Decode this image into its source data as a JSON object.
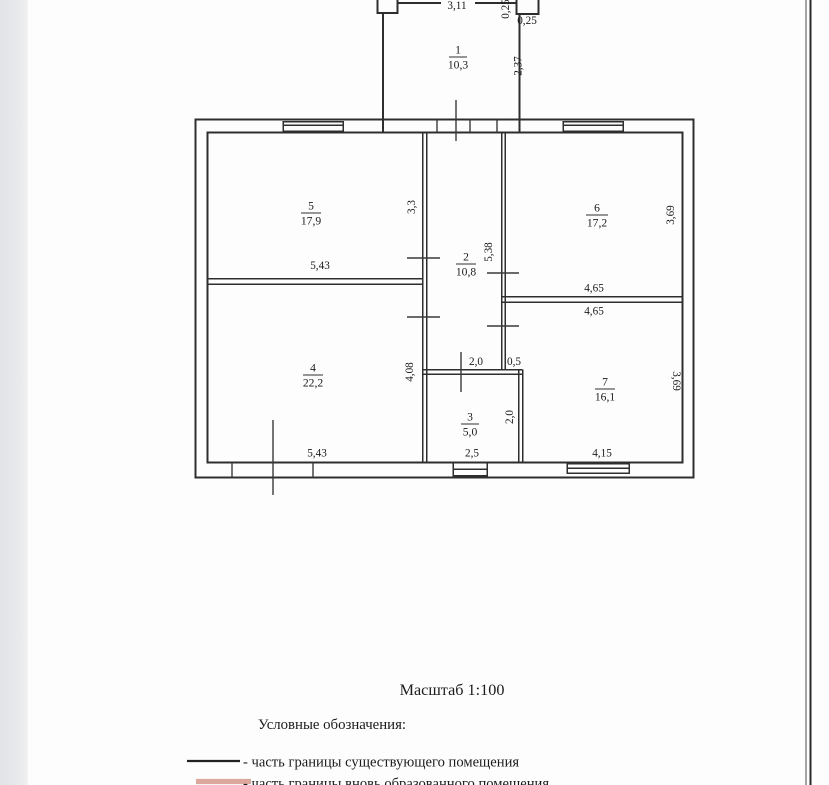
{
  "page": {
    "type": "scanned floor plan sheet",
    "scale_label": "Масштаб 1:100",
    "legend_title": "Условные обозначения:",
    "legend": [
      {
        "symbol": "solid-black-line",
        "label": "- часть границы существующего помещения"
      },
      {
        "symbol": "thick-salmon-line",
        "label": "- часть границы вновь образованного помещения"
      }
    ],
    "colors": {
      "drawing_line": "#2e2e2e",
      "legend_line_existing": "#222222",
      "legend_line_new": "#dca79d",
      "viewer_margin": "#e6e7ea",
      "paper": "#fdfdfd"
    }
  },
  "rooms": [
    {
      "number": "1",
      "area": "10,3"
    },
    {
      "number": "2",
      "area": "10,8"
    },
    {
      "number": "3",
      "area": "5,0"
    },
    {
      "number": "4",
      "area": "22,2"
    },
    {
      "number": "5",
      "area": "17,9"
    },
    {
      "number": "6",
      "area": "17,2"
    },
    {
      "number": "7",
      "area": "16,1"
    }
  ],
  "dims": {
    "room1_width": "3,11",
    "pier_height": "0,25",
    "pier_width": "0,25",
    "room1_depth": "2,37",
    "room5_width": "5,43",
    "room5_depth": "3,3",
    "corridor_depth": "5,38",
    "room6_width": "4,65",
    "room7_width_top": "4,65",
    "room6_depth": "3,69",
    "room4_depth": "4,08",
    "room3_width_top": "2,0",
    "wall_offset": "0,5",
    "room3_depth": "2,0",
    "room3_width": "2,5",
    "room4_width": "5,43",
    "room7_width": "4,15",
    "room7_depth": "3,69"
  }
}
